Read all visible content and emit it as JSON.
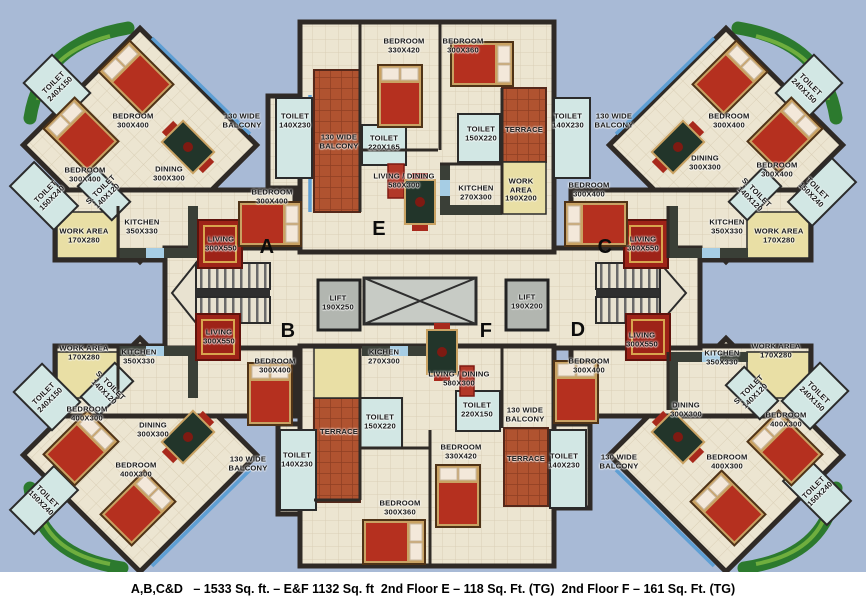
{
  "caption": {
    "text": "A,B,C&D   – 1533 Sq. ft. – E&F 1132 Sq. ft  2nd Floor E – 118 Sq. Ft. (TG)  2nd Floor F – 161 Sq. Ft. (TG)"
  },
  "units": [
    {
      "id": "A",
      "rooms": [
        "BEDROOM 300X400",
        "BEDROOM 300X400",
        "BEDROOM 300X400",
        "DINING 300X300",
        "KITCHEN 350X330",
        "WORK AREA 170X280",
        "LIVING 300X550",
        "TOILET 240X150",
        "TOILET 150X240",
        "S. TOILET 140X120",
        "TOILET 140X230",
        "130 WIDE BALCONY"
      ]
    },
    {
      "id": "B",
      "rooms": [
        "BEDROOM 400X300",
        "BEDROOM 400X300",
        "BEDROOM 300X400",
        "DINING 300X300",
        "KITCHEN 350X330",
        "WORK AREA 170X280",
        "LIVING 300X550",
        "TOILET 240X150",
        "TOILET 150X240",
        "S. TOILET 140X120",
        "TOILET 140X230",
        "130 WIDE BALCONY"
      ]
    },
    {
      "id": "C",
      "rooms": [
        "BEDROOM 300X400",
        "BEDROOM 300X400",
        "BEDROOM 300X400",
        "DINING 300X300",
        "KITCHEN 350X330",
        "WORK AREA 170X280",
        "LIVING 300X550",
        "TOILET 240X150",
        "TOILET 150X240",
        "S. TOILET 140X120",
        "TOILET 140X230",
        "130 WIDE BALCONY"
      ]
    },
    {
      "id": "D",
      "rooms": [
        "BEDROOM 400X300",
        "BEDROOM 400X300",
        "BEDROOM 300X400",
        "DINING 300X300",
        "KITCHEN 350X330",
        "WORK AREA 170X280",
        "LIVING 300X550",
        "TOILET 240X150",
        "TOILET 150X240",
        "S. TOILET 140X120",
        "TOILET 140X230",
        "130 WIDE BALCONY"
      ]
    },
    {
      "id": "E",
      "rooms": [
        "BEDROOM 330X420",
        "BEDROOM 300X360",
        "LIVING / DINING 580X300",
        "KITCHEN 270X300",
        "WORK AREA 190X200",
        "TOILET 220X165",
        "TOILET 150X220",
        "TOILET 140X230",
        "TERRACE",
        "130 WIDE BALCONY"
      ]
    },
    {
      "id": "F",
      "rooms": [
        "BEDROOM 330X420",
        "BEDROOM 300X360",
        "LIVING / DINING 580X300",
        "KICHEN 270X300",
        "TOILET 150X220",
        "TOILET 220X150",
        "TOILET 140X230",
        "TERRACE",
        "TERRACE",
        "130 WIDE BALCONY"
      ]
    }
  ],
  "lifts": [
    "LIFT 190X250",
    "LIFT 190X200"
  ],
  "areas_summary": {
    "A_B_C_D": "1533 Sq. ft.",
    "E_F": "1132 Sq. ft",
    "2nd_floor_E": "118 Sq. Ft. (TG)",
    "2nd_floor_F": "161 Sq. Ft. (TG)"
  },
  "colors": {
    "background": "#a8bad6",
    "floor": "#ece5d1",
    "wall": "#2f2a26",
    "terrace": "#b05330",
    "toilet": "#d2e7e4",
    "work_area": "#e9dfa5",
    "garden": "#2c7a2e",
    "water_edge": "#5e9fd4",
    "carpet": "#9e2318",
    "bed_wood": "#c9a263",
    "bed_blanket": "#b5301f",
    "caption_band": "#ffffff"
  },
  "floorplan": {
    "labels": [
      {
        "text": "TOILET\n240X150",
        "x": 57,
        "y": 86,
        "r": -45
      },
      {
        "text": "BEDROOM\n300X400",
        "x": 133,
        "y": 121,
        "r": 0
      },
      {
        "text": "DINING\n300X300",
        "x": 169,
        "y": 174,
        "r": 0
      },
      {
        "text": "BEDROOM\n300X400",
        "x": 85,
        "y": 175,
        "r": 0
      },
      {
        "text": "TOILET\n150X240",
        "x": 49,
        "y": 195,
        "r": -45
      },
      {
        "text": "S. TOILET\n140X120",
        "x": 104,
        "y": 193,
        "r": -45
      },
      {
        "text": "WORK AREA\n170X280",
        "x": 84,
        "y": 236,
        "r": 0
      },
      {
        "text": "KITCHEN\n350X330",
        "x": 142,
        "y": 227,
        "r": 0
      },
      {
        "text": "130 WIDE\nBALCONY",
        "x": 242,
        "y": 121,
        "r": 0
      },
      {
        "text": "LIVING\n300X550",
        "x": 221,
        "y": 244,
        "r": 0
      },
      {
        "text": "BEDROOM\n300X400",
        "x": 272,
        "y": 197,
        "r": 0
      },
      {
        "text": "A",
        "x": 267,
        "y": 247,
        "r": 0,
        "cls": "letter"
      },
      {
        "text": "TOILET\n140X230",
        "x": 295,
        "y": 121,
        "r": 0
      },
      {
        "text": "BEDROOM\n330X420",
        "x": 404,
        "y": 46,
        "r": 0
      },
      {
        "text": "BEDROOM\n300X360",
        "x": 463,
        "y": 46,
        "r": 0
      },
      {
        "text": "130 WIDE\nBALCONY",
        "x": 339,
        "y": 142,
        "r": 0
      },
      {
        "text": "TOILET\n220X165",
        "x": 384,
        "y": 143,
        "r": 0
      },
      {
        "text": "TOILET\n150X220",
        "x": 481,
        "y": 134,
        "r": 0
      },
      {
        "text": "TERRACE",
        "x": 524,
        "y": 130,
        "r": 0
      },
      {
        "text": "LIVING / DINING\n580X300",
        "x": 404,
        "y": 181,
        "r": 0
      },
      {
        "text": "KITCHEN\n270X300",
        "x": 476,
        "y": 193,
        "r": 0
      },
      {
        "text": "WORK\nAREA\n190X200",
        "x": 521,
        "y": 190,
        "r": 0
      },
      {
        "text": "E",
        "x": 379,
        "y": 229,
        "r": 0,
        "cls": "letter"
      },
      {
        "text": "TOILET\n140X230",
        "x": 568,
        "y": 121,
        "r": 0
      },
      {
        "text": "130 WIDE\nBALCONY",
        "x": 614,
        "y": 121,
        "r": 0
      },
      {
        "text": "BEDROOM\n300X400",
        "x": 729,
        "y": 121,
        "r": 0
      },
      {
        "text": "TOILET\n240X150",
        "x": 807,
        "y": 88,
        "r": 45
      },
      {
        "text": "DINING\n300X300",
        "x": 705,
        "y": 163,
        "r": 0
      },
      {
        "text": "BEDROOM\n300X400",
        "x": 777,
        "y": 170,
        "r": 0
      },
      {
        "text": "TOILET\n150X240",
        "x": 814,
        "y": 192,
        "r": 45
      },
      {
        "text": "S. TOILET\n140X120",
        "x": 753,
        "y": 196,
        "r": 45
      },
      {
        "text": "WORK AREA\n170X280",
        "x": 779,
        "y": 236,
        "r": 0
      },
      {
        "text": "KITCHEN\n350X330",
        "x": 727,
        "y": 227,
        "r": 0
      },
      {
        "text": "LIVING\n300X550",
        "x": 643,
        "y": 244,
        "r": 0
      },
      {
        "text": "BEDROOM\n300X400",
        "x": 589,
        "y": 190,
        "r": 0
      },
      {
        "text": "C",
        "x": 605,
        "y": 247,
        "r": 0,
        "cls": "letter"
      },
      {
        "text": "LIFT\n190X250",
        "x": 338,
        "y": 303,
        "r": 0
      },
      {
        "text": "LIFT\n190X200",
        "x": 527,
        "y": 302,
        "r": 0
      },
      {
        "text": "B",
        "x": 288,
        "y": 331,
        "r": 0,
        "cls": "letter"
      },
      {
        "text": "WORK AREA\n170X280",
        "x": 84,
        "y": 353,
        "r": 0
      },
      {
        "text": "KITCHEN\n350X330",
        "x": 139,
        "y": 357,
        "r": 0
      },
      {
        "text": "LIVING\n300X550",
        "x": 219,
        "y": 337,
        "r": 0
      },
      {
        "text": "BEDROOM\n300X400",
        "x": 275,
        "y": 366,
        "r": 0
      },
      {
        "text": "TOILET\n240X150",
        "x": 47,
        "y": 397,
        "r": -45
      },
      {
        "text": "S. TOILET\n140X120",
        "x": 107,
        "y": 389,
        "r": 45
      },
      {
        "text": "BEDROOM\n400X300",
        "x": 87,
        "y": 414,
        "r": 0
      },
      {
        "text": "DINING\n300X300",
        "x": 153,
        "y": 430,
        "r": 0
      },
      {
        "text": "BEDROOM\n400X300",
        "x": 136,
        "y": 470,
        "r": 0
      },
      {
        "text": "TOILET\n150X240",
        "x": 44,
        "y": 500,
        "r": 45
      },
      {
        "text": "130 WIDE\nBALCONY",
        "x": 248,
        "y": 464,
        "r": 0
      },
      {
        "text": "TOILET\n140X230",
        "x": 297,
        "y": 460,
        "r": 0
      },
      {
        "text": "F",
        "x": 486,
        "y": 331,
        "r": 0,
        "cls": "letter"
      },
      {
        "text": "KICHEN\n270X300",
        "x": 384,
        "y": 357,
        "r": 0
      },
      {
        "text": "LIVING / DINING\n580X300",
        "x": 459,
        "y": 379,
        "r": 0
      },
      {
        "text": "TOILET\n150X220",
        "x": 380,
        "y": 422,
        "r": 0
      },
      {
        "text": "TOILET\n220X150",
        "x": 477,
        "y": 410,
        "r": 0
      },
      {
        "text": "130 WIDE\nBALCONY",
        "x": 525,
        "y": 415,
        "r": 0
      },
      {
        "text": "TERRACE",
        "x": 339,
        "y": 432,
        "r": 0
      },
      {
        "text": "BEDROOM\n330X420",
        "x": 461,
        "y": 452,
        "r": 0
      },
      {
        "text": "TERRACE",
        "x": 526,
        "y": 459,
        "r": 0
      },
      {
        "text": "BEDROOM\n300X360",
        "x": 400,
        "y": 508,
        "r": 0
      },
      {
        "text": "D",
        "x": 578,
        "y": 330,
        "r": 0,
        "cls": "letter"
      },
      {
        "text": "BEDROOM\n300X400",
        "x": 589,
        "y": 366,
        "r": 0
      },
      {
        "text": "LIVING\n300X550",
        "x": 642,
        "y": 340,
        "r": 0
      },
      {
        "text": "KITCHEN\n350X330",
        "x": 722,
        "y": 358,
        "r": 0
      },
      {
        "text": "WORK AREA\n170X280",
        "x": 776,
        "y": 351,
        "r": 0
      },
      {
        "text": "DINING\n300X300",
        "x": 686,
        "y": 410,
        "r": 0
      },
      {
        "text": "TOILET\n140X230",
        "x": 564,
        "y": 461,
        "r": 0
      },
      {
        "text": "130 WIDE\nBALCONY",
        "x": 619,
        "y": 462,
        "r": 0
      },
      {
        "text": "BEDROOM\n400X300",
        "x": 786,
        "y": 420,
        "r": 0
      },
      {
        "text": "BEDROOM\n400X300",
        "x": 727,
        "y": 462,
        "r": 0
      },
      {
        "text": "TOILET\n240X150",
        "x": 815,
        "y": 396,
        "r": 45
      },
      {
        "text": "S. TOILET\n140X120",
        "x": 752,
        "y": 393,
        "r": -45
      },
      {
        "text": "TOILET\n150X240",
        "x": 817,
        "y": 491,
        "r": -45
      }
    ]
  }
}
